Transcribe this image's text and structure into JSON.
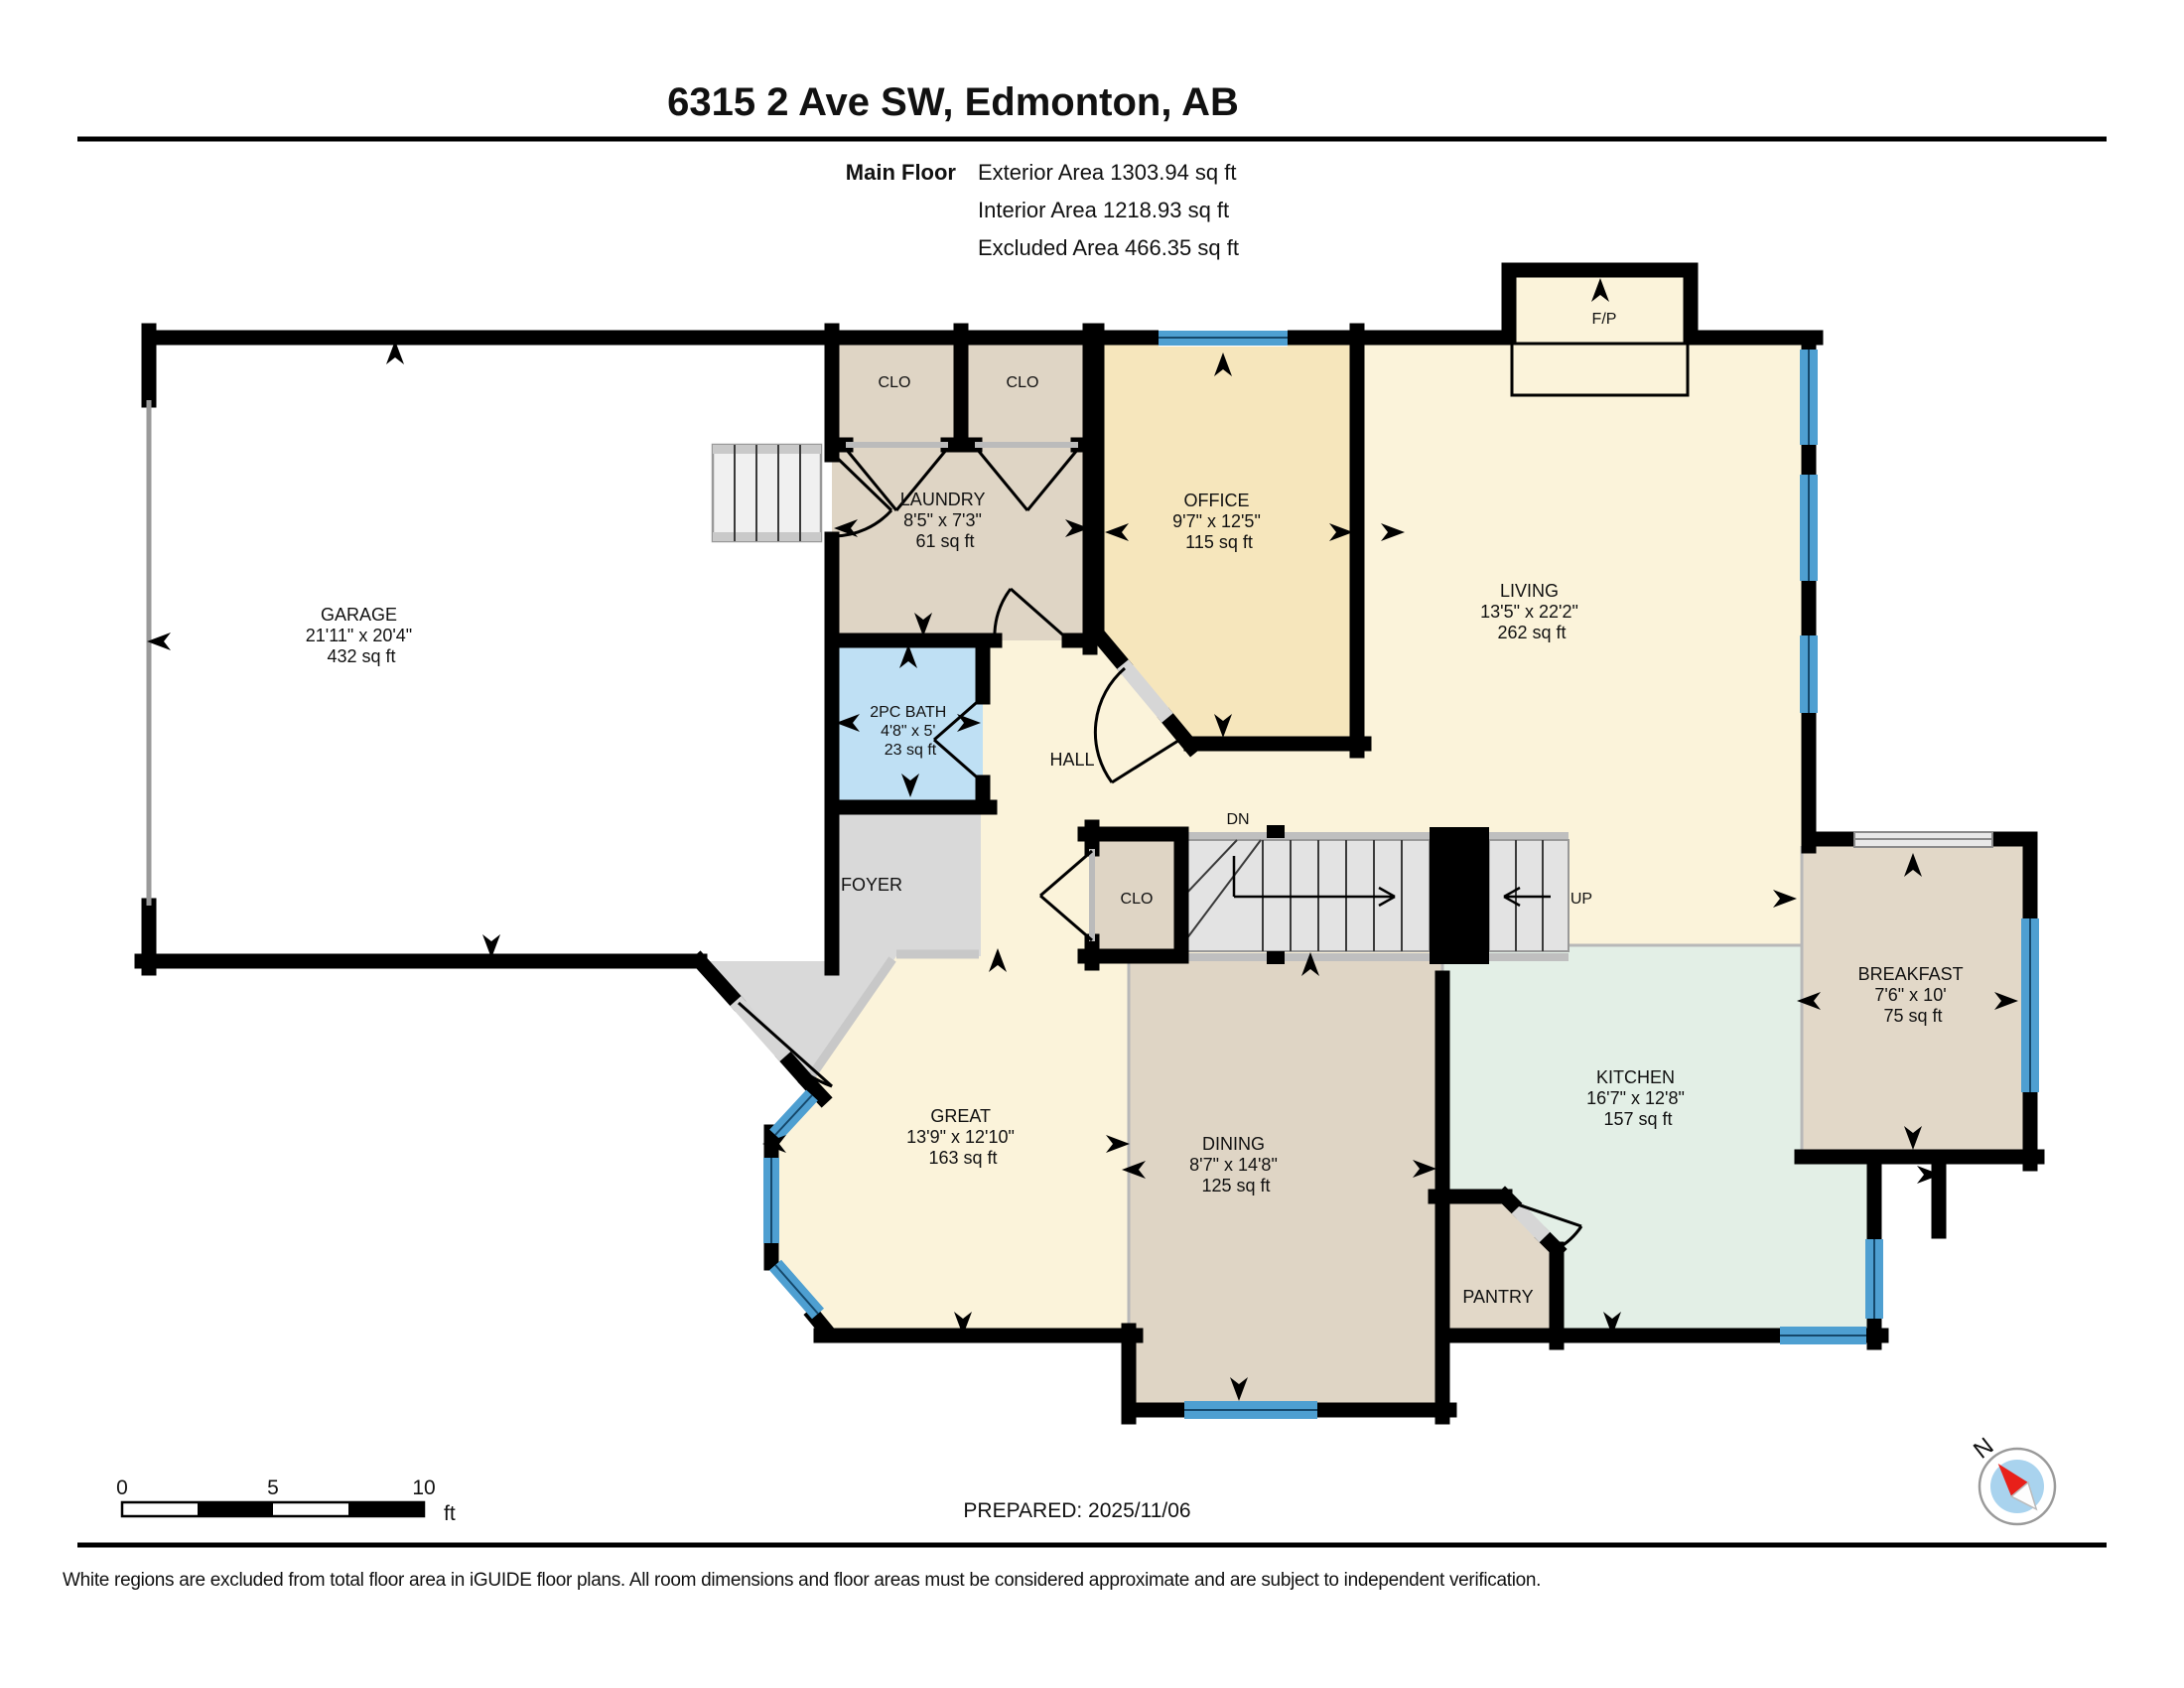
{
  "header": {
    "title": "6315 2 Ave SW, Edmonton, AB",
    "floor_label": "Main Floor",
    "area_lines": [
      "Exterior Area 1303.94 sq ft",
      "Interior Area 1218.93 sq ft",
      "Excluded Area 466.35 sq ft"
    ]
  },
  "rooms": {
    "garage": {
      "name": "GARAGE",
      "dims": "21'11\" x 20'4\"",
      "area": "432 sq ft"
    },
    "clo_left": {
      "name": "CLO"
    },
    "clo_right": {
      "name": "CLO"
    },
    "laundry": {
      "name": "LAUNDRY",
      "dims": "8'5\" x 7'3\"",
      "area": "61 sq ft"
    },
    "office": {
      "name": "OFFICE",
      "dims": "9'7\" x 12'5\"",
      "area": "115 sq ft"
    },
    "living": {
      "name": "LIVING",
      "dims": "13'5\" x 22'2\"",
      "area": "262 sq ft"
    },
    "fireplace": {
      "name": "F/P"
    },
    "bath": {
      "name": "2PC BATH",
      "dims": "4'8\" x 5'",
      "area": "23 sq ft"
    },
    "hall": {
      "name": "HALL"
    },
    "foyer": {
      "name": "FOYER"
    },
    "stair_closet": {
      "name": "CLO"
    },
    "stairs_down": {
      "name": "DN"
    },
    "stairs_up": {
      "name": "UP"
    },
    "breakfast": {
      "name": "BREAKFAST",
      "dims": "7'6\" x 10'",
      "area": "75 sq ft"
    },
    "great": {
      "name": "GREAT",
      "dims": "13'9\" x 12'10\"",
      "area": "163 sq ft"
    },
    "dining": {
      "name": "DINING",
      "dims": "8'7\" x 14'8\"",
      "area": "125 sq ft"
    },
    "kitchen": {
      "name": "KITCHEN",
      "dims": "16'7\" x 12'8\"",
      "area": "157 sq ft"
    },
    "pantry": {
      "name": "PANTRY"
    }
  },
  "footer": {
    "prepared": "PREPARED: 2025/11/06",
    "scale": {
      "ticks": [
        "0",
        "5",
        "10"
      ],
      "unit": "ft"
    },
    "compass_label": "N",
    "disclaimer": "White regions are excluded from total floor area in iGUIDE floor plans. All room dimensions and floor areas must be considered approximate and are subject to independent verification."
  },
  "colors": {
    "wall": "#000000",
    "floor_cream": "#FBF3DA",
    "floor_gold": "#F6E6BC",
    "floor_tan": "#DFD5C5",
    "floor_bath_blue": "#BFE0F4",
    "floor_kitchen_green": "#E3EFE6",
    "floor_grey": "#D9D9D9",
    "stairs_grey": "#E3E3E3",
    "window_blue": "#4E9FD1",
    "compass_blue": "#A9D3EE",
    "compass_red": "#E8201A"
  }
}
